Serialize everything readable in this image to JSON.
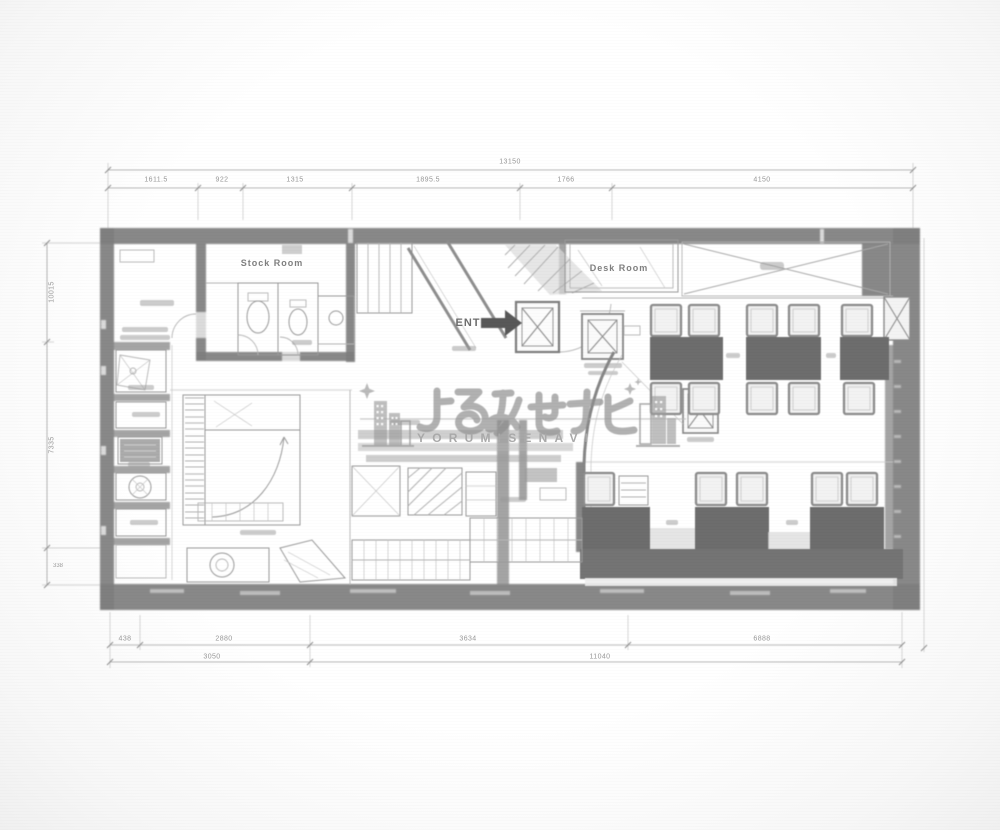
{
  "watermark": {
    "title": "よるみせナビ",
    "subtitle": "YORUMISENAVI"
  },
  "rooms": {
    "stock_room": "Stock Room",
    "desk_room": "Desk Room",
    "entrance": "ENT"
  },
  "dimensions": {
    "top_overall": "13150",
    "top_segments": [
      "1611.5",
      "922",
      "1315",
      "1895.5",
      "1766",
      "4150"
    ],
    "bottom_row1": [
      "438",
      "2880",
      "3634",
      "6888"
    ],
    "bottom_row2": [
      "3050",
      "11040"
    ],
    "left_vertical": [
      "10015",
      "7335",
      "338"
    ]
  },
  "colors": {
    "paper": "#fdfdfd",
    "wall": "#7f7f7f",
    "table": "#6d6d6d",
    "bench": "#747474",
    "line": "#9a9a9a",
    "watermark_text": "#8f8f8f",
    "dimension_text": "#979797"
  }
}
